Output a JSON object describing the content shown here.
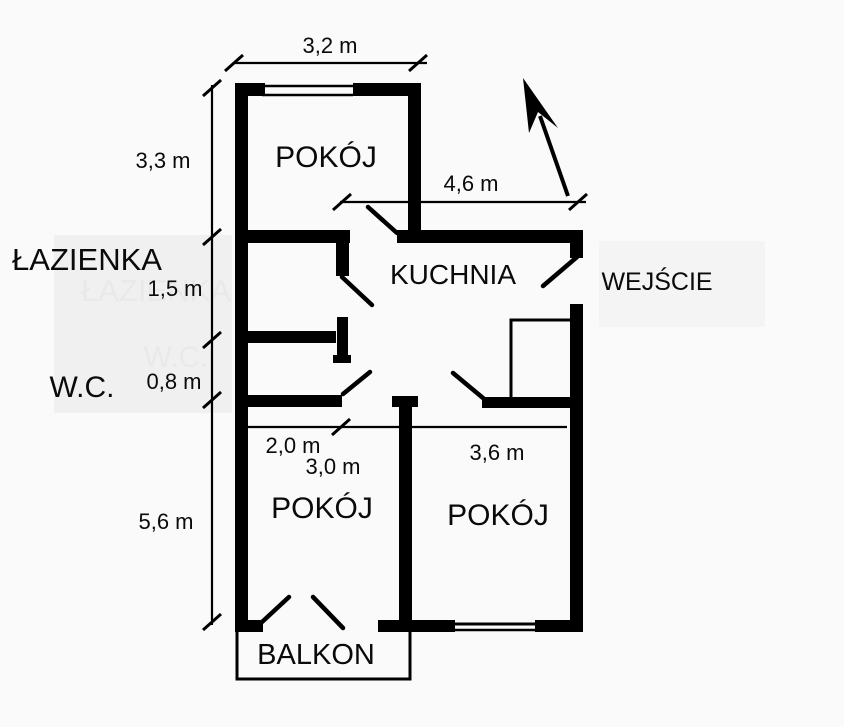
{
  "canvas": {
    "width": 844,
    "height": 727,
    "background": "#fafafa"
  },
  "colors": {
    "wall": "#000000",
    "text": "#0a0a0a",
    "bathroom_panel": "#f0f0f0",
    "entrance_panel": "#f4f4f4",
    "ghost_text": "#e9e9e9"
  },
  "rooms": {
    "top_room": "POKÓJ",
    "kitchen": "KUCHNIA",
    "bathroom": "ŁAZIENKA",
    "wc": "W.C.",
    "entrance": "WEJŚCIE",
    "bottom_left_room": "POKÓJ",
    "bottom_right_room": "POKÓJ",
    "balcony": "BALKON"
  },
  "dimensions": {
    "top_room_width": "3,2 m",
    "top_room_height": "3,3 m",
    "kitchen_width": "4,6 m",
    "bathroom_height": "1,5 m",
    "wc_height": "0,8 m",
    "bottom_rooms_height": "5,6 m",
    "hall_width": "2,0 m",
    "bottom_left_room_width": "3,0 m",
    "bottom_right_room_width": "3,6 m"
  },
  "watermarks": {
    "bathroom": "ŁAZIENKA",
    "wc": "W.C."
  }
}
